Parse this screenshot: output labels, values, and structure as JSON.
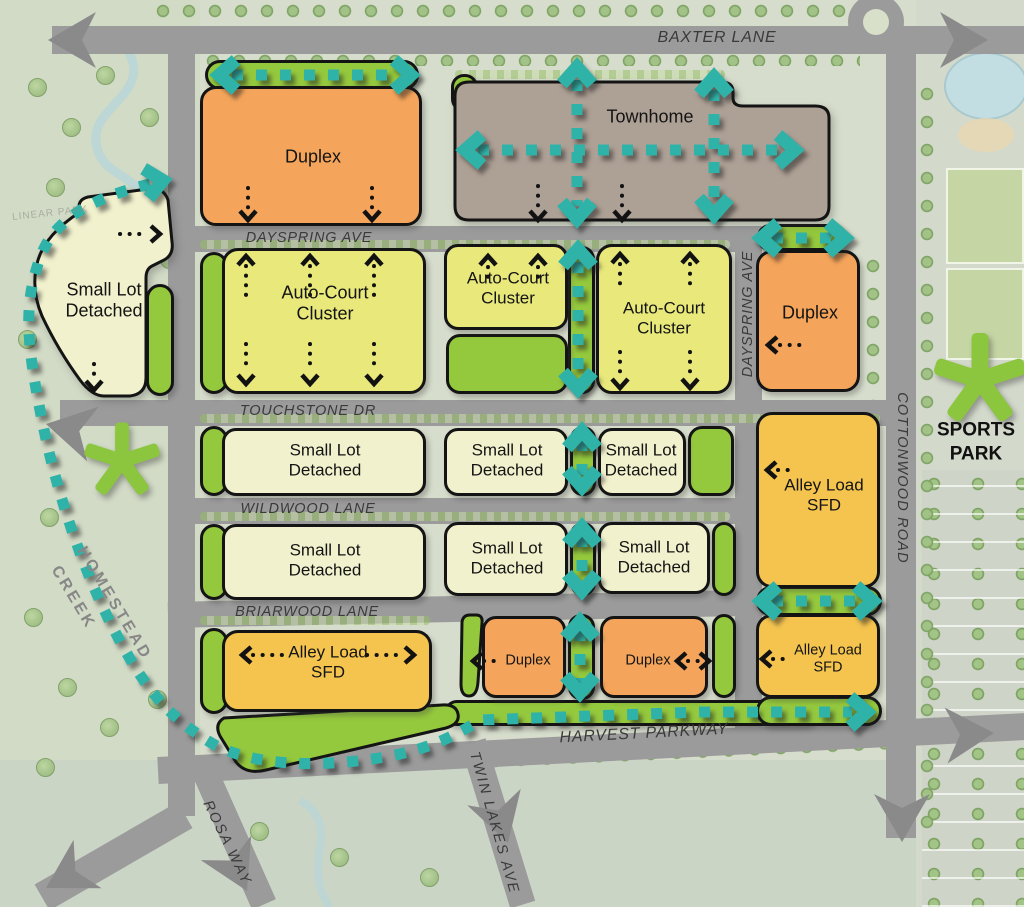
{
  "streets": {
    "baxter": "BAXTER LANE",
    "dayspring": "DAYSPRING AVE",
    "touchstone": "TOUCHSTONE DR",
    "wildwood": "WILDWOOD LANE",
    "briarwood": "BRIARWOOD LANE",
    "harvest": "HARVEST PARKWAY",
    "rosa": "ROSA WAY",
    "twin_lakes": "TWIN LAKES AVE",
    "cottonwood": "COTTONWOOD ROAD"
  },
  "zones": {
    "duplex": "Duplex",
    "townhome": "Townhome",
    "auto_court": "Auto-Court Cluster",
    "small_lot": "Small Lot Detached",
    "alley_load": "Alley Load SFD"
  },
  "landmarks": {
    "sports_park": "SPORTS PARK",
    "homestead": "HOMESTEAD",
    "creek": "CREEK",
    "linear_park": "LINEAR PARK"
  },
  "symbols": {
    "trail": "teal-dotted-pedestrian-trail",
    "access_arrow": "black-dotted-access-arrow",
    "road_arrow": "gray-road-continuation-arrow",
    "park_star": "green-park-asterisk",
    "roundabout": "roundabout"
  },
  "colors": {
    "road": "#9B9B9B",
    "road_arrow": "#8A8A8A",
    "duplex": "#F5A55B",
    "townhome": "#ADA095",
    "auto_court": "#E9E87B",
    "small_lot": "#F1F1CE",
    "alley_load": "#F4C44F",
    "park_green": "#94C83D",
    "trail_teal": "#2FB3A8",
    "outline": "#141414",
    "background": "#D7DDCC",
    "water": "#C2DEE2"
  }
}
